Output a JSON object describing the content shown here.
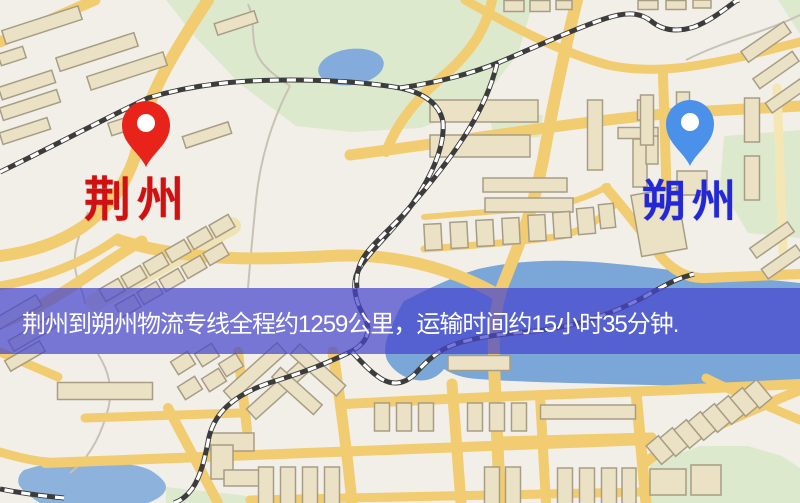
{
  "banner": {
    "text": "荆州到朔州物流专线全程约1259公里，运输时间约15小时35分钟.",
    "bg_color": "rgba(70,70,205,0.72)",
    "text_color": "#ffffff",
    "top": 288,
    "height": 66
  },
  "markers": {
    "origin": {
      "label": "荆州",
      "label_color": "#d01111",
      "pin_color": "#e8231a",
      "pin_tip_x": 146,
      "pin_tip_y": 167,
      "label_x": 84,
      "label_y": 176
    },
    "destination": {
      "label": "朔州",
      "label_color": "#2328d4",
      "pin_color": "#4b90e9",
      "pin_tip_x": 690,
      "pin_tip_y": 166,
      "label_x": 642,
      "label_y": 180
    }
  },
  "palette": {
    "map_background": "#f2efe8",
    "road": "#f1cc70",
    "road_pale": "#efe2b4",
    "park_green": "#dde9cd",
    "water_blue": "#7ba6d8",
    "lake_blue": "#83abdc",
    "building_fill": "#ebe2c6",
    "building_stroke": "#a79d85",
    "railway_dark": "#3c3c3c",
    "railway_light": "#ffffff",
    "stream_gray": "#c8c2b6"
  },
  "map": {
    "parks": [
      {
        "points": "166,0 534,0 518,54 474,110 420,128 352,132 296,126 240,84 196,38"
      },
      {
        "points": "490,118 543,115 540,137 494,140"
      },
      {
        "points": "724,136 800,130 800,238 748,233 720,186"
      },
      {
        "points": "650,464 700,446 748,446 782,456 800,468 800,503 650,503"
      },
      {
        "points": "166,487 240,495 286,503 166,503"
      },
      {
        "points": "778,0 800,0 800,34"
      }
    ],
    "waters": [
      {
        "d": "M404,301 C430,288 452,277 478,269 C510,262 540,260 572,261 C612,262 650,268 690,272 C727,276 764,279 800,283 L800,389 C765,388 730,387 695,386 C650,385 610,384 570,383 C535,382 505,381 478,379 C462,378 452,374 444,369 C438,377 428,382 416,380 C404,378 393,371 387,360 C383,350 386,338 392,326 C396,316 400,307 404,301 Z"
      },
      {
        "d": "M24,470 C45,463 70,460 92,461 C118,462 140,465 150,470 C160,476 166,482 166,487 C166,494 158,499 148,503 L40,503 C30,497 22,490 19,485 C17,479 19,474 24,470 Z",
        "fill": "#8db3dd"
      },
      {
        "ellipse": [
          351,
          67,
          33,
          18,
          -8
        ],
        "fill": "#83abdc"
      }
    ],
    "streams": [
      {
        "d": "M248,4 C256,22 250,40 258,56 C264,68 276,76 290,86"
      },
      {
        "d": "M290,86 C272,120 260,160 256,200 C253,232 250,262 248,288"
      },
      {
        "d": "M88,212 C78,236 70,258 78,280 C82,292 85,298 85,304"
      },
      {
        "d": "M98,354 C112,376 113,396 106,416 C99,440 88,459 70,473"
      },
      {
        "d": "M686,60 C710,48 734,40 758,32 C775,26 790,20 800,15"
      }
    ],
    "roads": [
      {
        "d": "M95,302 L232,226",
        "w": 18,
        "c": "#efe2b4"
      },
      {
        "d": "M0,42 L95,0",
        "w": 11
      },
      {
        "d": "M208,0 C175,50 148,95 140,135 C134,172 116,202 84,226 C55,246 24,253 0,256",
        "w": 12
      },
      {
        "d": "M0,286 C45,278 85,262 118,238",
        "w": 9
      },
      {
        "d": "M0,324 C62,300 100,264 142,241",
        "w": 11
      },
      {
        "d": "M118,240 C190,262 260,260 330,256 C405,252 462,274 500,296",
        "w": 12
      },
      {
        "d": "M386,152 C398,120 420,95 448,72 C470,52 486,30 492,0",
        "w": 10
      },
      {
        "d": "M577,0 C562,60 552,110 543,160 C532,215 516,252 504,282 C496,302 493,330 494,360 C495,400 498,450 500,503",
        "w": 12
      },
      {
        "d": "M350,155 C480,138 600,118 690,112 L800,106",
        "w": 11
      },
      {
        "d": "M465,0 C515,28 560,52 608,65 C655,75 700,66 745,56 L800,42",
        "w": 9
      },
      {
        "d": "M663,75 L668,238",
        "w": 10
      },
      {
        "d": "M777,88 L783,252",
        "w": 9,
        "c": "#f5e6b5"
      },
      {
        "d": "M424,217 C470,213 520,210 556,206 C580,200 598,192 608,186",
        "w": 6
      },
      {
        "d": "M424,249 C480,245 530,241 562,236 C590,228 605,215 614,205",
        "w": 7
      },
      {
        "d": "M606,188 C630,215 648,240 662,258 C675,272 690,279 706,278 L800,274",
        "w": 10
      },
      {
        "d": "M238,352 L247,430",
        "w": 10
      },
      {
        "d": "M168,408 L218,503",
        "w": 10
      },
      {
        "d": "M333,352 C340,400 347,450 352,503",
        "w": 11
      },
      {
        "d": "M452,384 L461,503",
        "w": 11
      },
      {
        "d": "M540,396 L546,503",
        "w": 10
      },
      {
        "d": "M636,392 L646,503",
        "w": 11
      },
      {
        "d": "M345,404 C460,398 560,394 650,391 L800,384",
        "w": 10
      },
      {
        "d": "M497,441 L652,437",
        "w": 9
      },
      {
        "d": "M45,463 C250,455 450,449 648,440",
        "w": 10
      },
      {
        "d": "M250,500 L640,492",
        "w": 9
      },
      {
        "d": "M800,390 C745,413 700,433 662,452 C650,458 645,462 643,466",
        "w": 10
      },
      {
        "d": "M706,378 C740,395 772,408 800,420",
        "w": 9
      },
      {
        "d": "M0,352 L58,377",
        "w": 9
      },
      {
        "d": "M0,452 C20,458 35,461 48,462",
        "w": 9
      },
      {
        "d": "M85,418 L240,413",
        "w": 9
      }
    ],
    "railways": [
      {
        "d": "M0,172 C50,148 98,122 148,98 C195,84 240,80 290,80 C330,80 365,82 400,88 C425,93 440,105 443,122 C445,148 430,180 408,210 C385,240 362,258 356,276 C352,292 358,306 365,318 C372,332 366,344 350,352 C322,366 295,375 272,382 C235,394 215,412 209,437 C205,458 201,476 192,489 C186,497 180,501 174,503"
      },
      {
        "d": "M400,88 C440,82 470,74 500,62 C540,45 572,30 604,19 C628,11 641,13 651,21 C663,31 678,32 694,27 C710,21 724,10 736,1 L739,0"
      },
      {
        "d": "M497,64 C490,92 476,120 458,146 C440,172 420,196 402,216 C385,234 370,246 362,260 C357,270 356,280 357,288"
      },
      {
        "d": "M352,352 C360,360 368,370 380,378 C392,386 404,384 414,375 C424,364 432,356 444,349 C465,338 500,334 535,331 C575,327 612,314 644,297 C660,288 672,281 684,277 L694,274"
      },
      {
        "d": "M64,498 C42,496 20,493 0,489"
      }
    ],
    "buildings": [
      [
        42,
        25,
        80,
        14,
        -18
      ],
      [
        97,
        52,
        82,
        14,
        -18
      ],
      [
        127,
        71,
        80,
        14,
        -18
      ],
      [
        27,
        85,
        56,
        13,
        -18
      ],
      [
        30,
        105,
        60,
        13,
        -18
      ],
      [
        12,
        56,
        26,
        12,
        -18
      ],
      [
        25,
        131,
        50,
        12,
        -18
      ],
      [
        136,
        121,
        55,
        13,
        -18
      ],
      [
        207,
        135,
        48,
        12,
        -18
      ],
      [
        236,
        23,
        42,
        12,
        -18
      ],
      [
        112,
        290,
        22,
        14,
        -30
      ],
      [
        134,
        277,
        22,
        14,
        -30
      ],
      [
        156,
        264,
        22,
        14,
        -30
      ],
      [
        178,
        251,
        22,
        14,
        -30
      ],
      [
        200,
        238,
        22,
        14,
        -30
      ],
      [
        222,
        226,
        22,
        14,
        -30
      ],
      [
        128,
        306,
        22,
        14,
        -30
      ],
      [
        150,
        293,
        22,
        14,
        -30
      ],
      [
        172,
        280,
        22,
        14,
        -30
      ],
      [
        194,
        267,
        22,
        14,
        -30
      ],
      [
        216,
        254,
        22,
        14,
        -30
      ],
      [
        18,
        312,
        48,
        12,
        -30
      ],
      [
        32,
        334,
        48,
        12,
        -30
      ],
      [
        25,
        356,
        40,
        12,
        -30
      ],
      [
        255,
        372,
        72,
        14,
        -42
      ],
      [
        278,
        390,
        72,
        14,
        -42
      ],
      [
        318,
        370,
        62,
        14,
        42
      ],
      [
        297,
        391,
        56,
        13,
        42
      ],
      [
        183,
        363,
        20,
        15,
        -32
      ],
      [
        207,
        355,
        20,
        15,
        -32
      ],
      [
        231,
        365,
        20,
        15,
        -32
      ],
      [
        190,
        388,
        20,
        15,
        -32
      ],
      [
        214,
        380,
        20,
        15,
        -32
      ],
      [
        484,
        111,
        108,
        22,
        0
      ],
      [
        480,
        146,
        100,
        22,
        0
      ],
      [
        595,
        135,
        15,
        70,
        0
      ],
      [
        644,
        110,
        13,
        20,
        0
      ],
      [
        640,
        163,
        14,
        48,
        0
      ],
      [
        525,
        185,
        84,
        14,
        0
      ],
      [
        529,
        205,
        88,
        14,
        0
      ],
      [
        433,
        237,
        17,
        26,
        -3
      ],
      [
        459,
        235,
        17,
        26,
        -3
      ],
      [
        485,
        233,
        17,
        26,
        -3
      ],
      [
        511,
        231,
        17,
        26,
        -3
      ],
      [
        537,
        228,
        17,
        26,
        -3
      ],
      [
        562,
        225,
        17,
        26,
        -4
      ],
      [
        586,
        221,
        17,
        26,
        -5
      ],
      [
        607,
        216,
        15,
        24,
        -6
      ],
      [
        638,
        133,
        40,
        11,
        0
      ],
      [
        652,
        150,
        12,
        28,
        0
      ],
      [
        647,
        120,
        13,
        50,
        0
      ],
      [
        683,
        118,
        13,
        52,
        0
      ],
      [
        692,
        183,
        30,
        24,
        0
      ],
      [
        659,
        222,
        46,
        62,
        -10
      ],
      [
        766,
        42,
        52,
        13,
        -35
      ],
      [
        776,
        70,
        48,
        12,
        -35
      ],
      [
        786,
        96,
        42,
        12,
        -35
      ],
      [
        772,
        240,
        46,
        12,
        -35
      ],
      [
        782,
        262,
        42,
        12,
        -35
      ],
      [
        752,
        120,
        15,
        44,
        0
      ],
      [
        752,
        178,
        15,
        44,
        0
      ],
      [
        514,
        6,
        20,
        11,
        0
      ],
      [
        540,
        6,
        20,
        11,
        0
      ],
      [
        564,
        5,
        16,
        9,
        0
      ],
      [
        648,
        5,
        20,
        9,
        0
      ],
      [
        676,
        5,
        20,
        9,
        0
      ],
      [
        702,
        4,
        18,
        8,
        0
      ],
      [
        105,
        391,
        95,
        17,
        0
      ],
      [
        232,
        442,
        44,
        18,
        0
      ],
      [
        222,
        462,
        22,
        34,
        0
      ],
      [
        244,
        478,
        40,
        16,
        0
      ],
      [
        266,
        486,
        15,
        38,
        0
      ],
      [
        288,
        486,
        15,
        38,
        0
      ],
      [
        310,
        486,
        15,
        38,
        0
      ],
      [
        332,
        486,
        15,
        38,
        0
      ],
      [
        382,
        417,
        15,
        28,
        0
      ],
      [
        404,
        417,
        15,
        28,
        0
      ],
      [
        426,
        417,
        15,
        28,
        0
      ],
      [
        475,
        417,
        15,
        28,
        0
      ],
      [
        497,
        417,
        15,
        28,
        0
      ],
      [
        519,
        417,
        15,
        28,
        0
      ],
      [
        588,
        412,
        95,
        14,
        0
      ],
      [
        492,
        487,
        15,
        40,
        0
      ],
      [
        513,
        487,
        15,
        40,
        0
      ],
      [
        565,
        488,
        15,
        40,
        0
      ],
      [
        587,
        488,
        15,
        40,
        0
      ],
      [
        609,
        488,
        15,
        40,
        0
      ],
      [
        629,
        488,
        14,
        40,
        0
      ],
      [
        668,
        482,
        36,
        26,
        0
      ],
      [
        706,
        480,
        30,
        30,
        0
      ],
      [
        660,
        450,
        16,
        24,
        -40
      ],
      [
        674,
        442,
        16,
        24,
        -40
      ],
      [
        688,
        434,
        16,
        24,
        -40
      ],
      [
        702,
        426,
        16,
        24,
        -40
      ],
      [
        716,
        418,
        16,
        24,
        -40
      ],
      [
        730,
        410,
        16,
        24,
        -40
      ],
      [
        744,
        402,
        16,
        24,
        -40
      ],
      [
        758,
        394,
        16,
        24,
        -40
      ],
      [
        479,
        363,
        62,
        15,
        0
      ]
    ]
  }
}
